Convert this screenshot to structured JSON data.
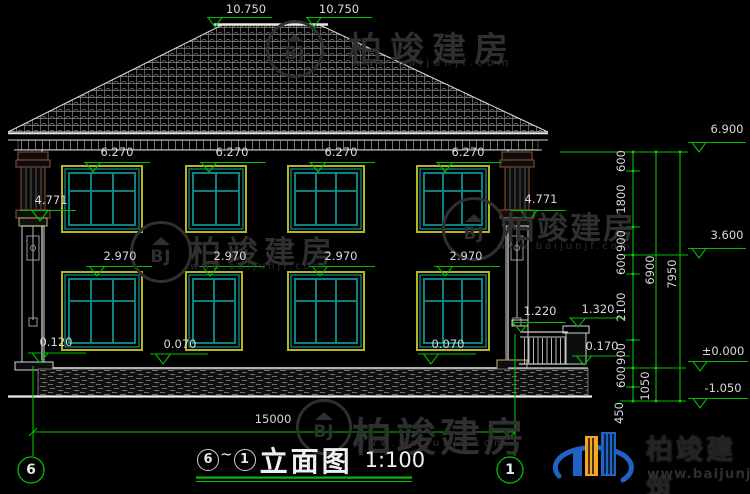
{
  "title": {
    "from": "6",
    "sep": "~",
    "to": "1",
    "text": "立面图",
    "scale": "1:100"
  },
  "grid": {
    "left": "6",
    "right": "1"
  },
  "elev": {
    "ridge": [
      "10.750",
      "10.750"
    ],
    "upper": [
      "6.270",
      "6.270",
      "6.270",
      "6.270"
    ],
    "capital": [
      "4.771",
      "4.771"
    ],
    "lower": [
      "2.970",
      "2.970",
      "2.970",
      "2.970"
    ],
    "base": "0.120",
    "floor": [
      "0.070",
      "0.070"
    ],
    "rail": "1.220",
    "pillar": "1.320",
    "fence": "0.170",
    "right": [
      "6.900",
      "3.600",
      "±0.000",
      "-1.050"
    ]
  },
  "dims": {
    "total": "15000",
    "chain": [
      "600",
      "1800",
      "900",
      "600",
      "2100",
      "900",
      "600",
      "450"
    ],
    "floor_total": "6900",
    "below_total": "1050",
    "overall": "7950"
  },
  "watermark": {
    "brand": "柏竣建房",
    "url": "www.baijunjf.com",
    "monogram": "BJ"
  },
  "logo": {
    "brand": "柏竣建筑",
    "url": "www.baijunjz.com"
  },
  "colors": {
    "background": "#000000",
    "linework": "#e6e6e6",
    "annotation_green": "#00bf00",
    "frame_yellow": "#b5b520",
    "sash_teal": "#0d9090",
    "capital_brown": "#7d4533",
    "stone_tan": "#a59558",
    "watermark_gray": "#2f2f2f",
    "logo_blue": "#1f63c4",
    "logo_orange": "#f5a623"
  }
}
